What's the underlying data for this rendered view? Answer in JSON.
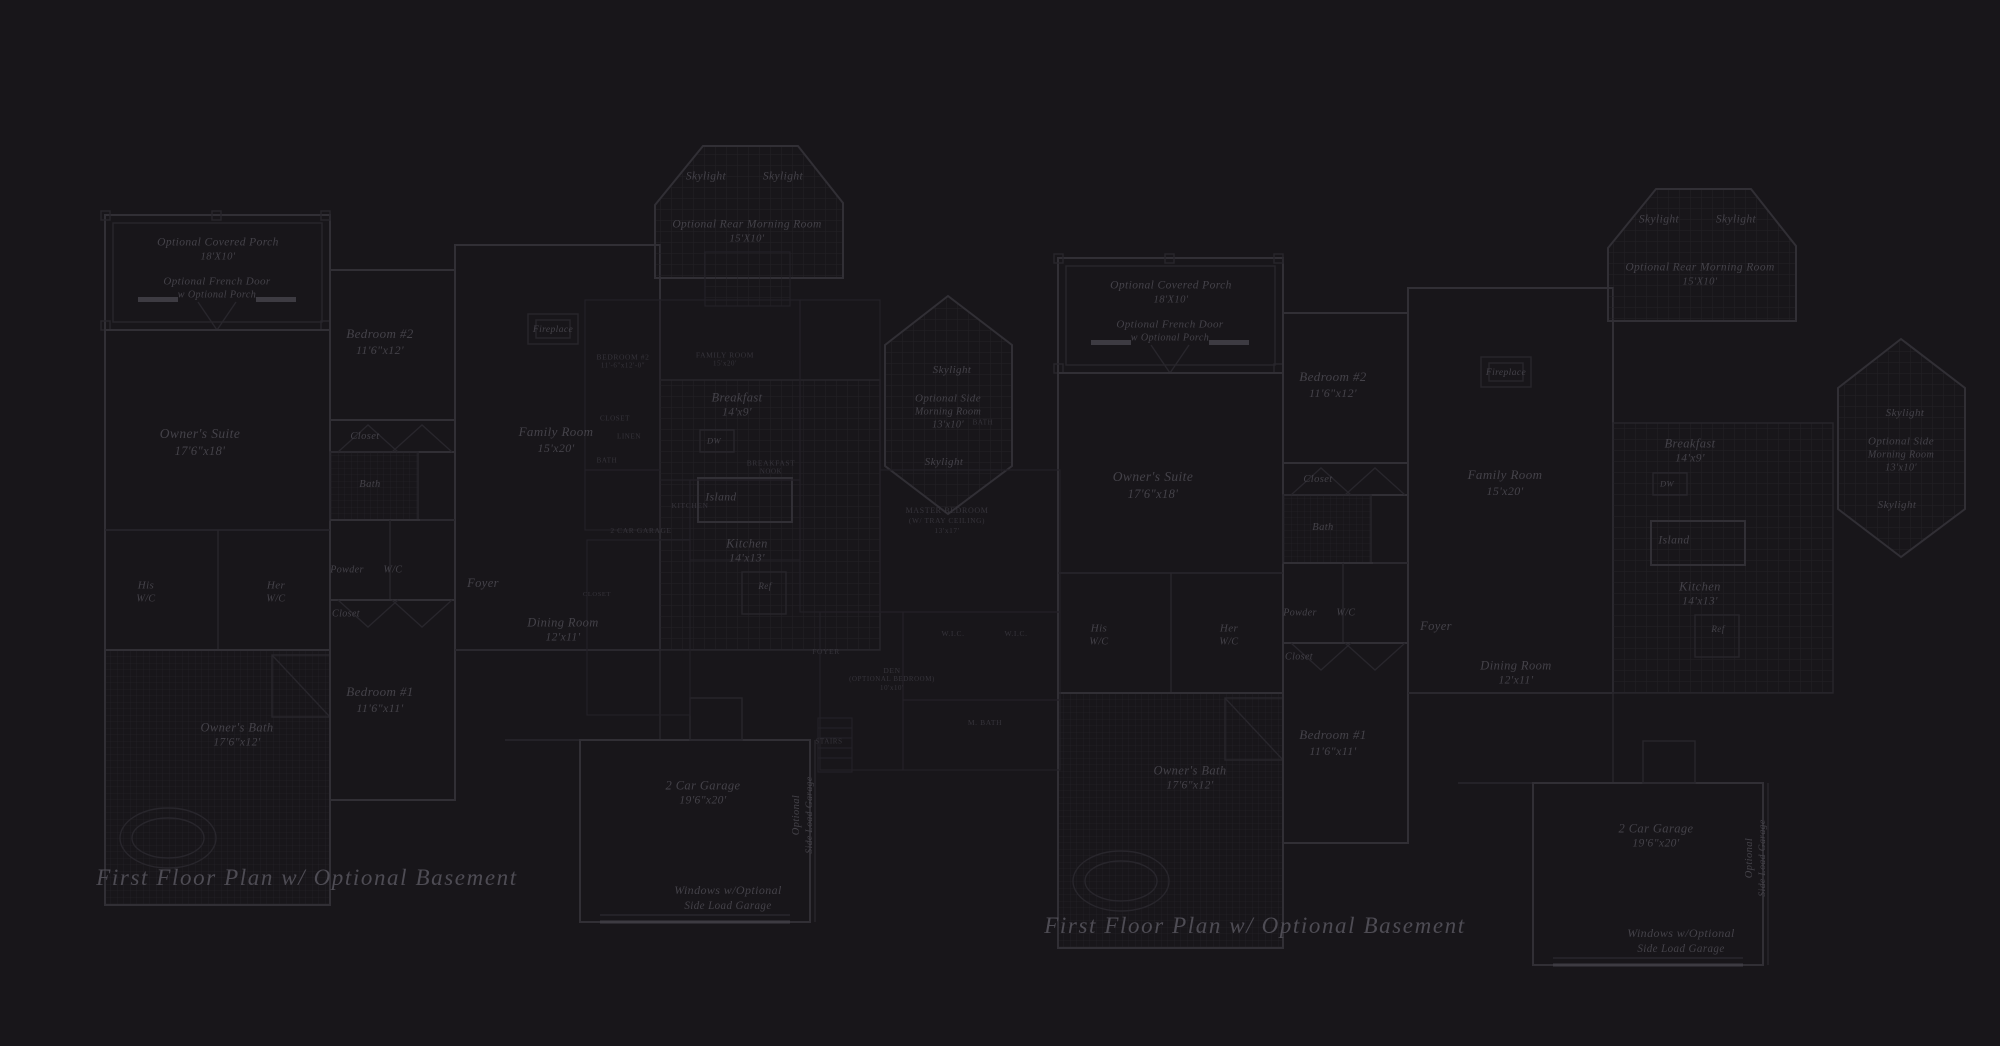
{
  "colors": {
    "background": "#18161a",
    "wall_line": "#312f35",
    "wall_line_faint": "#28262c",
    "wall_line_bright": "#3d3b42",
    "small_plan_line": "#232127",
    "tile_grid": "#232126",
    "room_label_text": "#444249",
    "small_caps_text": "#36343b",
    "caption_text": "#4e4c54"
  },
  "plans": {
    "left_plan": {
      "style": "script",
      "labels": [
        {
          "lines": [
            "Optional Covered Porch",
            "18'X10'"
          ],
          "x": 218,
          "y": 250,
          "size": 11.5
        },
        {
          "lines": [
            "Optional French Door",
            "w Optional Porch"
          ],
          "x": 217,
          "y": 288,
          "size": 11
        },
        {
          "lines": [
            "Skylight"
          ],
          "x": 706,
          "y": 177,
          "size": 11.5
        },
        {
          "lines": [
            "Skylight"
          ],
          "x": 783,
          "y": 177,
          "size": 11.5
        },
        {
          "lines": [
            "Optional Rear Morning Room",
            "15'X10'"
          ],
          "x": 747,
          "y": 232,
          "size": 11.5
        },
        {
          "lines": [
            "Bedroom #2",
            "11'6\"x12'"
          ],
          "x": 380,
          "y": 342,
          "size": 13
        },
        {
          "lines": [
            "Closet"
          ],
          "x": 365,
          "y": 437,
          "size": 10.5
        },
        {
          "lines": [
            "Bath"
          ],
          "x": 370,
          "y": 485,
          "size": 10.5
        },
        {
          "lines": [
            "Owner's Suite",
            "17'6\"x18'"
          ],
          "x": 200,
          "y": 442,
          "size": 13.5
        },
        {
          "lines": [
            "Family Room",
            "15'x20'"
          ],
          "x": 556,
          "y": 440,
          "size": 13
        },
        {
          "lines": [
            "Fireplace"
          ],
          "x": 553,
          "y": 330,
          "size": 9.5
        },
        {
          "lines": [
            "His",
            "W/C"
          ],
          "x": 146,
          "y": 592,
          "size": 11
        },
        {
          "lines": [
            "Her",
            "W/C"
          ],
          "x": 276,
          "y": 592,
          "size": 11
        },
        {
          "lines": [
            "Powder"
          ],
          "x": 347,
          "y": 570,
          "size": 10
        },
        {
          "lines": [
            "W/C"
          ],
          "x": 393,
          "y": 570,
          "size": 10
        },
        {
          "lines": [
            "Closet"
          ],
          "x": 346,
          "y": 614,
          "size": 10
        },
        {
          "lines": [
            "Foyer"
          ],
          "x": 483,
          "y": 583,
          "size": 12.5
        },
        {
          "lines": [
            "Dining Room",
            "12'x11'"
          ],
          "x": 563,
          "y": 630,
          "size": 12.5
        },
        {
          "lines": [
            "Bedroom #1",
            "11'6\"x11'"
          ],
          "x": 380,
          "y": 700,
          "size": 13
        },
        {
          "lines": [
            "Owner's Bath",
            "17'6\"x12'"
          ],
          "x": 237,
          "y": 735,
          "size": 12.5
        },
        {
          "lines": [
            "Breakfast",
            "14'x9'"
          ],
          "x": 737,
          "y": 405,
          "size": 12.5
        },
        {
          "lines": [
            "DW"
          ],
          "x": 714,
          "y": 441,
          "size": 8.5
        },
        {
          "lines": [
            "Island"
          ],
          "x": 721,
          "y": 498,
          "size": 11.5
        },
        {
          "lines": [
            "Kitchen",
            "14'x13'"
          ],
          "x": 747,
          "y": 551,
          "size": 12.5
        },
        {
          "lines": [
            "Ref"
          ],
          "x": 765,
          "y": 587,
          "size": 9
        },
        {
          "lines": [
            "Skylight"
          ],
          "x": 952,
          "y": 370,
          "size": 11
        },
        {
          "lines": [
            "Optional Side",
            "Morning Room",
            "13'x10'"
          ],
          "x": 948,
          "y": 412,
          "size": 11
        },
        {
          "lines": [
            "Skylight"
          ],
          "x": 944,
          "y": 462,
          "size": 11
        },
        {
          "lines": [
            "2 Car Garage",
            "19'6\"x20'"
          ],
          "x": 703,
          "y": 793,
          "size": 12.5
        },
        {
          "lines": [
            "Optional",
            "Side Load Garage"
          ],
          "x": 803,
          "y": 815,
          "size": 10.5,
          "rot": -90
        },
        {
          "lines": [
            "Windows w/Optional",
            "Side Load Garage"
          ],
          "x": 728,
          "y": 898,
          "size": 12
        }
      ]
    },
    "middle_plan": {
      "style": "caps",
      "labels": [
        {
          "lines": [
            "BEDROOM #2",
            "11'-6\"x12'-0\""
          ],
          "x": 623,
          "y": 362,
          "size": 7.5
        },
        {
          "lines": [
            "FAMILY ROOM",
            "15'x20'"
          ],
          "x": 725,
          "y": 360,
          "size": 7.5
        },
        {
          "lines": [
            "CLOSET"
          ],
          "x": 615,
          "y": 419,
          "size": 7
        },
        {
          "lines": [
            "LINEN"
          ],
          "x": 629,
          "y": 437,
          "size": 7
        },
        {
          "lines": [
            "BATH"
          ],
          "x": 607,
          "y": 461,
          "size": 7
        },
        {
          "lines": [
            "BREAKFAST",
            "NOOK"
          ],
          "x": 771,
          "y": 468,
          "size": 7.5
        },
        {
          "lines": [
            "KITCHEN"
          ],
          "x": 690,
          "y": 506,
          "size": 7.5
        },
        {
          "lines": [
            "2 CAR GARAGE"
          ],
          "x": 641,
          "y": 531,
          "size": 7.5
        },
        {
          "lines": [
            "MASTER BEDROOM",
            "(W/ TRAY CEILING)",
            "13'x17'"
          ],
          "x": 947,
          "y": 521,
          "size": 8
        },
        {
          "lines": [
            "BATH"
          ],
          "x": 983,
          "y": 423,
          "size": 7
        },
        {
          "lines": [
            "W.I.C."
          ],
          "x": 953,
          "y": 634,
          "size": 7.5
        },
        {
          "lines": [
            "W.I.C."
          ],
          "x": 1016,
          "y": 634,
          "size": 7.5
        },
        {
          "lines": [
            "M. BATH"
          ],
          "x": 985,
          "y": 723,
          "size": 7.5
        },
        {
          "lines": [
            "DEN",
            "(OPTIONAL BEDROOM)",
            "10'x10'"
          ],
          "x": 892,
          "y": 680,
          "size": 7.5
        },
        {
          "lines": [
            "FOYER"
          ],
          "x": 826,
          "y": 652,
          "size": 7.5
        },
        {
          "lines": [
            "STAIRS"
          ],
          "x": 829,
          "y": 742,
          "size": 7
        },
        {
          "lines": [
            "CLOSET"
          ],
          "x": 597,
          "y": 595,
          "size": 6.5
        }
      ]
    },
    "right_plan": {
      "style": "script",
      "labels": [
        {
          "lines": [
            "Optional Covered Porch",
            "18'X10'"
          ],
          "x": 1171,
          "y": 293,
          "size": 11.5
        },
        {
          "lines": [
            "Optional French Door",
            "w Optional Porch"
          ],
          "x": 1170,
          "y": 331,
          "size": 11
        },
        {
          "lines": [
            "Skylight"
          ],
          "x": 1659,
          "y": 220,
          "size": 11.5
        },
        {
          "lines": [
            "Skylight"
          ],
          "x": 1736,
          "y": 220,
          "size": 11.5
        },
        {
          "lines": [
            "Optional Rear Morning Room",
            "15'X10'"
          ],
          "x": 1700,
          "y": 275,
          "size": 11.5
        },
        {
          "lines": [
            "Bedroom #2",
            "11'6\"x12'"
          ],
          "x": 1333,
          "y": 385,
          "size": 13
        },
        {
          "lines": [
            "Closet"
          ],
          "x": 1318,
          "y": 480,
          "size": 10.5
        },
        {
          "lines": [
            "Bath"
          ],
          "x": 1323,
          "y": 528,
          "size": 10.5
        },
        {
          "lines": [
            "Owner's Suite",
            "17'6\"x18'"
          ],
          "x": 1153,
          "y": 485,
          "size": 13.5
        },
        {
          "lines": [
            "Family Room",
            "15'x20'"
          ],
          "x": 1505,
          "y": 483,
          "size": 13
        },
        {
          "lines": [
            "Fireplace"
          ],
          "x": 1506,
          "y": 373,
          "size": 9.5
        },
        {
          "lines": [
            "His",
            "W/C"
          ],
          "x": 1099,
          "y": 635,
          "size": 11
        },
        {
          "lines": [
            "Her",
            "W/C"
          ],
          "x": 1229,
          "y": 635,
          "size": 11
        },
        {
          "lines": [
            "Powder"
          ],
          "x": 1300,
          "y": 613,
          "size": 10
        },
        {
          "lines": [
            "W/C"
          ],
          "x": 1346,
          "y": 613,
          "size": 10
        },
        {
          "lines": [
            "Closet"
          ],
          "x": 1299,
          "y": 657,
          "size": 10
        },
        {
          "lines": [
            "Foyer"
          ],
          "x": 1436,
          "y": 626,
          "size": 12.5
        },
        {
          "lines": [
            "Dining Room",
            "12'x11'"
          ],
          "x": 1516,
          "y": 673,
          "size": 12.5
        },
        {
          "lines": [
            "Bedroom #1",
            "11'6\"x11'"
          ],
          "x": 1333,
          "y": 743,
          "size": 13
        },
        {
          "lines": [
            "Owner's Bath",
            "17'6\"x12'"
          ],
          "x": 1190,
          "y": 778,
          "size": 12.5
        },
        {
          "lines": [
            "Breakfast",
            "14'x9'"
          ],
          "x": 1690,
          "y": 451,
          "size": 12.5
        },
        {
          "lines": [
            "DW"
          ],
          "x": 1667,
          "y": 484,
          "size": 8.5
        },
        {
          "lines": [
            "Island"
          ],
          "x": 1674,
          "y": 541,
          "size": 11.5
        },
        {
          "lines": [
            "Kitchen",
            "14'x13'"
          ],
          "x": 1700,
          "y": 594,
          "size": 12.5
        },
        {
          "lines": [
            "Ref"
          ],
          "x": 1718,
          "y": 630,
          "size": 9
        },
        {
          "lines": [
            "Skylight"
          ],
          "x": 1905,
          "y": 413,
          "size": 11
        },
        {
          "lines": [
            "Optional Side",
            "Morning Room",
            "13'x10'"
          ],
          "x": 1901,
          "y": 455,
          "size": 11
        },
        {
          "lines": [
            "Skylight"
          ],
          "x": 1897,
          "y": 505,
          "size": 11
        },
        {
          "lines": [
            "2 Car Garage",
            "19'6\"x20'"
          ],
          "x": 1656,
          "y": 836,
          "size": 12.5
        },
        {
          "lines": [
            "Optional",
            "Side Load Garage"
          ],
          "x": 1756,
          "y": 858,
          "size": 10.5,
          "rot": -90
        },
        {
          "lines": [
            "Windows w/Optional",
            "Side Load Garage"
          ],
          "x": 1681,
          "y": 941,
          "size": 12
        }
      ]
    },
    "annotations": {
      "style": "caption",
      "labels": [
        {
          "lines": [
            "First Floor Plan  w/ Optional Basement"
          ],
          "x": 307,
          "y": 878,
          "size": 23
        },
        {
          "lines": [
            "First Floor Plan  w/ Optional Basement"
          ],
          "x": 1255,
          "y": 926,
          "size": 23
        }
      ]
    }
  }
}
